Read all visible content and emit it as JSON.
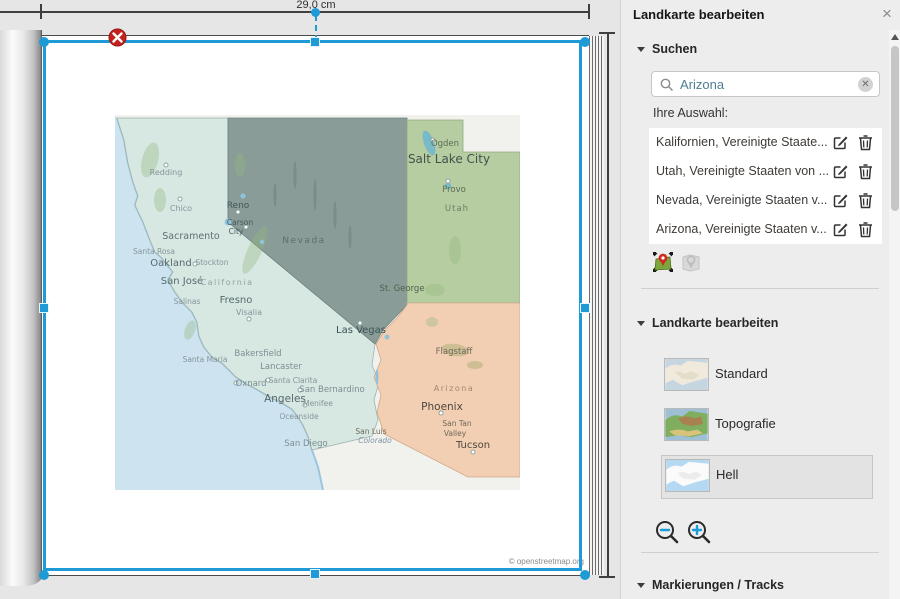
{
  "measure": {
    "width_label": "29,0 cm"
  },
  "panel": {
    "title": "Landkarte bearbeiten",
    "close_label": "×",
    "search": {
      "section_label": "Suchen",
      "input_value": "Arizona",
      "selection_label": "Ihre Auswahl:",
      "items": [
        {
          "name": "Kalifornien, Vereinigte Staate..."
        },
        {
          "name": "Utah, Vereinigte Staaten von ..."
        },
        {
          "name": "Nevada, Vereinigte Staaten v..."
        },
        {
          "name": "Arizona, Vereinigte Staaten v..."
        }
      ]
    },
    "map_style": {
      "section_label": "Landkarte bearbeiten",
      "options": [
        {
          "label": "Standard",
          "selected": false
        },
        {
          "label": "Topografie",
          "selected": false
        },
        {
          "label": "Hell",
          "selected": true
        }
      ]
    },
    "markers_section_label": "Markierungen / Tracks"
  },
  "map": {
    "attribution": "© openstreetmap.org",
    "labels": [
      {
        "t": "Redding",
        "x": 51,
        "y": 60,
        "s": 8,
        "c": "#85969b"
      },
      {
        "t": "Chico",
        "x": 66,
        "y": 96,
        "s": 8,
        "c": "#85969b"
      },
      {
        "t": "Reno",
        "x": 123,
        "y": 93,
        "s": 9,
        "c": "#44585c"
      },
      {
        "t": "Carson",
        "x": 125,
        "y": 110,
        "s": 7.5,
        "c": "#44585c"
      },
      {
        "t": "City",
        "x": 121,
        "y": 119,
        "s": 7.5,
        "c": "#44585c"
      },
      {
        "t": "Sacramento",
        "x": 76,
        "y": 124,
        "s": 9.5,
        "c": "#5e7175"
      },
      {
        "t": "Santa Rosa",
        "x": 39,
        "y": 139,
        "s": 7.5,
        "c": "#85969b"
      },
      {
        "t": "Oakland",
        "x": 56,
        "y": 151,
        "s": 10,
        "c": "#566a6e"
      },
      {
        "t": "Stockton",
        "x": 97,
        "y": 150,
        "s": 7.5,
        "c": "#85969b"
      },
      {
        "t": "San José",
        "x": 67,
        "y": 169,
        "s": 10,
        "c": "#566a6e"
      },
      {
        "t": "California",
        "x": 112,
        "y": 170,
        "s": 8,
        "c": "#93a39b",
        "ls": 1.5
      },
      {
        "t": "Salinas",
        "x": 72,
        "y": 189,
        "s": 7.5,
        "c": "#85969b"
      },
      {
        "t": "Fresno",
        "x": 121,
        "y": 188,
        "s": 10,
        "c": "#566a6e"
      },
      {
        "t": "Visalia",
        "x": 134,
        "y": 200,
        "s": 8,
        "c": "#85969b"
      },
      {
        "t": "Santa Maria",
        "x": 90,
        "y": 247,
        "s": 7.5,
        "c": "#85969b"
      },
      {
        "t": "Bakersfield",
        "x": 143,
        "y": 241,
        "s": 8.5,
        "c": "#7c8e92"
      },
      {
        "t": "Lancaster",
        "x": 166,
        "y": 254,
        "s": 8.5,
        "c": "#7c8e92"
      },
      {
        "t": "Oxnard",
        "x": 136,
        "y": 271,
        "s": 8.5,
        "c": "#7c8e92"
      },
      {
        "t": "Santa Clarita",
        "x": 178,
        "y": 268,
        "s": 7.5,
        "c": "#85969b"
      },
      {
        "t": "San Bernardino",
        "x": 217,
        "y": 277,
        "s": 8.5,
        "c": "#7c8e92"
      },
      {
        "t": "Angeles",
        "x": 170,
        "y": 287,
        "s": 10.5,
        "c": "#54686c"
      },
      {
        "t": "Menifee",
        "x": 203,
        "y": 291,
        "s": 7.5,
        "c": "#85969b"
      },
      {
        "t": "Oceanside",
        "x": 184,
        "y": 304,
        "s": 7.5,
        "c": "#85969b"
      },
      {
        "t": "San Diego",
        "x": 191,
        "y": 331,
        "s": 8.5,
        "c": "#7c8e92"
      },
      {
        "t": "Nevada",
        "x": 189,
        "y": 128,
        "s": 9,
        "c": "#5d6f6b",
        "ls": 1.5
      },
      {
        "t": "Las Vegas",
        "x": 246,
        "y": 218,
        "s": 10,
        "c": "#3e5254"
      },
      {
        "t": "Ogden",
        "x": 330,
        "y": 31,
        "s": 8.5,
        "c": "#5a6d57"
      },
      {
        "t": "Salt Lake City",
        "x": 334,
        "y": 48,
        "s": 12,
        "c": "#41524e"
      },
      {
        "t": "Provo",
        "x": 339,
        "y": 77,
        "s": 8.5,
        "c": "#5a6d57"
      },
      {
        "t": "Utah",
        "x": 342,
        "y": 96,
        "s": 8.5,
        "c": "#6c7f68",
        "ls": 1
      },
      {
        "t": "St. George",
        "x": 287,
        "y": 176,
        "s": 8.5,
        "c": "#51604e"
      },
      {
        "t": "Flagstaff",
        "x": 339,
        "y": 239,
        "s": 8.5,
        "c": "#6e695c"
      },
      {
        "t": "Arizona",
        "x": 339,
        "y": 276,
        "s": 8,
        "c": "#a08a72",
        "ls": 1.5
      },
      {
        "t": "Phoenix",
        "x": 327,
        "y": 295,
        "s": 10.5,
        "c": "#4c473f"
      },
      {
        "t": "San Tan",
        "x": 342,
        "y": 311,
        "s": 7.5,
        "c": "#6e695c"
      },
      {
        "t": "Valley",
        "x": 340,
        "y": 321,
        "s": 7.5,
        "c": "#6e695c"
      },
      {
        "t": "Tucson",
        "x": 358,
        "y": 333,
        "s": 10,
        "c": "#4c473f"
      },
      {
        "t": "San Luis",
        "x": 256,
        "y": 319,
        "s": 7.5,
        "c": "#6e695c"
      },
      {
        "t": "Colorado",
        "x": 260,
        "y": 328,
        "s": 7.5,
        "c": "#8095a5",
        "i": true
      }
    ],
    "dots": [
      {
        "x": 65,
        "y": 84
      },
      {
        "x": 123,
        "y": 97
      },
      {
        "x": 131,
        "y": 112
      },
      {
        "x": 80,
        "y": 149
      },
      {
        "x": 134,
        "y": 204
      },
      {
        "x": 153,
        "y": 265
      },
      {
        "x": 185,
        "y": 275
      },
      {
        "x": 190,
        "y": 290
      },
      {
        "x": 121,
        "y": 268
      },
      {
        "x": 245,
        "y": 208
      },
      {
        "x": 326,
        "y": 298
      },
      {
        "x": 333,
        "y": 66
      },
      {
        "x": 318,
        "y": 25
      },
      {
        "x": 51,
        "y": 50
      },
      {
        "x": 358,
        "y": 337
      }
    ]
  },
  "colors": {
    "accent": "#1e9bd7",
    "delete_red": "#c4211d",
    "california": "#d7e7e2",
    "nevada": "#839792",
    "utah": "#b6cca1",
    "arizona": "#f2ceb2",
    "water": "#cde3ef"
  }
}
